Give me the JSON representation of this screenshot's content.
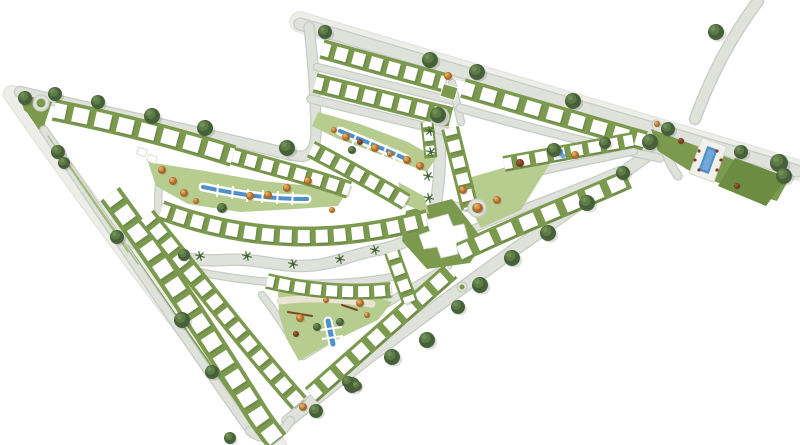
{
  "page": {
    "type": "residential-master-plan-illustration",
    "background": "#ffffff"
  },
  "palette": {
    "road": "#dfe1db",
    "road_casing": "#c8ccc4",
    "pale": "#edeee9",
    "pale_casing": "#e2e4de",
    "green": "#7c9a4e",
    "park": "#b7cd90",
    "lawn": "#6b8c41",
    "water": "#4f90c8",
    "water_light": "#72a9d6",
    "house": "#fefefe",
    "house_edge": "#d8dbd2",
    "shadow": "rgba(70,80,60,0.22)",
    "tree_dark": "#46613a",
    "tree_dark_mid": "#5d7b47",
    "tree_dark_hi": "#6f8f55",
    "tree_orange": "#a86a2c",
    "tree_orange_mid": "#cf9045",
    "tree_orange_hi": "#e4b062",
    "tree_brown": "#6e3a20",
    "tree_brown_mid": "#8a5030",
    "tree_brown_hi": "#a06038",
    "palm": "#4e7340",
    "lot_line": "#a3b97a",
    "plaza": "#e9e5d2",
    "equipment": "#7a4a28",
    "lounger": "#8a3b2a"
  },
  "map": {
    "roads": [
      {
        "n": "outer-street-left",
        "d": "M 12,94 C 100,220 190,340 278,446",
        "w": 16,
        "c": "#edeee9",
        "cc": "#e2e4de"
      },
      {
        "n": "left-green-strip",
        "d": "M 26,104 C 100,212 180,328 256,434",
        "w": 8,
        "c": "#7c9a4e",
        "cc": "none"
      },
      {
        "n": "top-boulevard-verge",
        "d": "M 300,22 L 798,170",
        "w": 19,
        "c": "#edeee9",
        "cc": "#e2e4de"
      },
      {
        "n": "top-boulevard",
        "d": "M 300,24 L 797,171",
        "w": 11
      },
      {
        "n": "top-right-stub",
        "d": "M 758,1 C 731,37 711,75 695,119",
        "w": 10
      },
      {
        "n": "northwest-boundary",
        "d": "M 20,92 C 108,113 203,133 292,155",
        "w": 10
      },
      {
        "n": "northwest-branch",
        "d": "M 292,155 C 312,161 317,146 316,124 C 315,95 313,58 309,27",
        "w": 9
      },
      {
        "n": "left-lane",
        "d": "M 44,130 C 95,205 170,318 248,428",
        "w": 7
      },
      {
        "n": "southeast-boundary",
        "d": "M 288,421 C 390,338 510,252 658,148",
        "w": 11
      },
      {
        "n": "tip-connector",
        "d": "M 250,431 C 264,442 280,437 290,421",
        "w": 8
      },
      {
        "n": "central-boulevard",
        "d": "M 130,240 C 160,256 190,262 225,260 C 258,258 272,266 302,266 C 332,266 352,254 377,250 C 410,245 431,228 436,201 C 441,173 440,146 440,119",
        "w": 10
      },
      {
        "n": "lane-t1-t2",
        "d": "M 317,67 L 453,101",
        "w": 6
      },
      {
        "n": "lane-t2-park",
        "d": "M 311,99 L 452,133",
        "w": 7
      },
      {
        "n": "lane-vertical",
        "d": "M 452,83 L 461,122",
        "w": 6
      },
      {
        "n": "lane-t3-south",
        "d": "M 460,108 C 530,128 600,146 660,158",
        "w": 7
      },
      {
        "n": "lane-rc2-rc1",
        "d": "M 497,182 C 550,168 595,160 634,151",
        "w": 6
      },
      {
        "n": "lane-rc1-top",
        "d": "M 452,238 C 515,210 570,192 620,170",
        "w": 6
      },
      {
        "n": "culdesac-stub",
        "d": "M 452,205 L 468,208",
        "w": 6
      },
      {
        "n": "lane-south-boulevard",
        "d": "M 172,266 C 240,283 320,290 392,277",
        "w": 6
      },
      {
        "n": "lane-playground-west",
        "d": "M 262,295 C 277,314 289,334 301,353",
        "w": 6
      },
      {
        "n": "lane-br1-top",
        "d": "M 303,356 C 350,327 398,296 448,266",
        "w": 6
      },
      {
        "n": "lane-v-middle",
        "d": "M 155,224 C 205,287 252,343 303,398",
        "w": 6
      },
      {
        "n": "lane-bv1-bv2",
        "d": "M 126,205 C 172,268 218,337 262,420",
        "w": 6
      },
      {
        "n": "lane-intersection-up",
        "d": "M 168,260 C 159,230 156,202 160,176",
        "w": 6
      },
      {
        "n": "parcel-access",
        "d": "M 656,124 C 662,144 668,162 678,176",
        "w": 7
      }
    ],
    "areas": [
      {
        "n": "park-lens-main",
        "pts": "148,162 205,171 262,181 312,186 346,193 338,206 296,209 240,212 188,204 156,186",
        "f": "#b7cd90"
      },
      {
        "n": "park-lens-upper",
        "pts": "318,112 360,124 408,142 436,158 427,172 384,156 336,138 312,126",
        "f": "#b7cd90"
      },
      {
        "n": "park-playground",
        "pts": "278,292 314,286 374,296 392,302 378,320 340,338 314,352 299,361 286,338 279,314",
        "f": "#b7cd90"
      },
      {
        "n": "clubhouse-green",
        "pts": "406,211 452,199 484,241 470,263 427,269 402,241",
        "f": "#7c9a4e"
      },
      {
        "n": "park-wedge",
        "pts": "468,178 541,157 559,149 521,210 481,228 469,206",
        "f": "#b7cd90"
      },
      {
        "n": "amenity-parcel-band",
        "pts": "651,129 705,149 761,170 789,179 777,201 733,189 688,170 658,151",
        "f": "#7c9a4e"
      },
      {
        "n": "amenity-parcel-lawn",
        "pts": "735,158 787,177 766,206 718,186",
        "f": "#6b8c41"
      },
      {
        "n": "corner-wedge-green",
        "pts": "20,94 52,102 44,126 24,110",
        "f": "#7c9a4e"
      },
      {
        "n": "triangle-green-m3",
        "pts": "398,182 424,196 429,214 404,204",
        "f": "#b7cd90"
      }
    ],
    "lines": [
      {
        "n": "lot-line",
        "d": "M 48,136 L 120,240",
        "w": 1.2,
        "c": "#a3b97a"
      },
      {
        "n": "lot-line",
        "d": "M 58,150 L 128,252",
        "w": 1.2,
        "c": "#a3b97a"
      },
      {
        "n": "lot-line",
        "d": "M 70,166 L 138,264",
        "w": 1.2,
        "c": "#a3b97a"
      },
      {
        "n": "plaza-path",
        "d": "M 280,301 C 310,297 342,299 372,304",
        "w": 7,
        "c": "#e9e5d2"
      },
      {
        "n": "playground-equipment",
        "d": "M 288,312 L 312,316",
        "w": 2,
        "c": "#7a4a28"
      },
      {
        "n": "playground-equipment",
        "d": "M 342,305 L 357,310",
        "w": 2,
        "c": "#7a4a28"
      }
    ],
    "strips": [
      {
        "n": "housing-row-t1",
        "d": "M 322,49 L 445,83",
        "w": 20,
        "hw": 13,
        "dash": "12 6"
      },
      {
        "n": "housing-row-t2",
        "d": "M 315,83 L 451,117",
        "w": 20,
        "hw": 13,
        "dash": "12 6"
      },
      {
        "n": "housing-row-t3",
        "d": "M 463,88 L 645,141",
        "w": 20,
        "hw": 13,
        "dash": "15 8"
      },
      {
        "n": "housing-row-rc2",
        "d": "M 504,164 L 633,140",
        "w": 16,
        "hw": 11,
        "dash": "12 6"
      },
      {
        "n": "housing-row-rc1",
        "d": "M 459,253 C 515,226 570,205 628,179",
        "w": 20,
        "hw": 14,
        "dash": "16 8"
      },
      {
        "n": "housing-row-rc3",
        "d": "M 450,128 L 470,208",
        "w": 18,
        "hw": 12,
        "dash": "11 6"
      },
      {
        "n": "housing-row-m1a",
        "d": "M 54,110 C 118,123 180,139 233,156",
        "w": 22,
        "hw": 15,
        "dash": "16 7"
      },
      {
        "n": "housing-row-m1b",
        "d": "M 233,156 C 272,167 312,177 349,190",
        "w": 18,
        "hw": 12,
        "dash": "11 6"
      },
      {
        "n": "housing-row-m3",
        "d": "M 311,149 C 345,167 376,184 406,202",
        "w": 18,
        "hw": 12,
        "dash": "11 6"
      },
      {
        "n": "housing-row-m4",
        "d": "M 161,210 C 245,241 330,246 428,219",
        "w": 20,
        "hw": 13,
        "dash": "12 6"
      },
      {
        "n": "housing-row-bs1",
        "d": "M 267,281 C 310,291 350,294 391,290",
        "w": 16,
        "hw": 11,
        "dash": "11 5"
      },
      {
        "n": "housing-row-bv1",
        "d": "M 110,194 C 160,262 205,330 256,412 C 262,422 270,432 277,441",
        "w": 24,
        "hw": 16,
        "dash": "15 7"
      },
      {
        "n": "housing-row-bv2",
        "d": "M 146,216 C 195,276 245,342 299,403",
        "w": 20,
        "hw": 13,
        "dash": "12 6"
      },
      {
        "n": "housing-row-br1",
        "d": "M 311,395 C 360,352 405,312 451,271",
        "w": 19,
        "hw": 13,
        "dash": "14 7"
      },
      {
        "n": "housing-row-br2",
        "d": "M 392,252 C 398,270 404,285 410,302",
        "w": 16,
        "hw": 11,
        "dash": "11 6"
      },
      {
        "n": "housing-row-mini",
        "d": "M 427,122 L 431,158",
        "w": 13,
        "hw": 9,
        "dash": "9 5"
      }
    ],
    "water": [
      {
        "n": "canal-upper-park",
        "d": "M 340,131 C 362,140 386,150 406,159",
        "w": 4,
        "uw": 9,
        "cross": [
          "352,145 357,133",
          "367,151 372,139",
          "382,157 387,145",
          "393,162 398,150"
        ]
      },
      {
        "n": "canal-main-park",
        "d": "M 203,187 C 245,196 275,199 307,199",
        "w": 4,
        "uw": 9,
        "cross": [
          "218,184 217,197",
          "233,186 232,199",
          "248,189 247,202",
          "263,190 262,203",
          "278,191 277,204",
          "293,192 292,205"
        ]
      },
      {
        "n": "water-playground",
        "d": "M 328,321 L 333,344",
        "w": 5,
        "uw": 9,
        "cross": [
          "320,330 342,327",
          "322,339 343,336"
        ]
      }
    ],
    "rects": [
      {
        "n": "pool-deck",
        "x": 708,
        "y": 160,
        "w": 26,
        "h": 38,
        "r": 20,
        "f": "#f0f1ea",
        "s": "#d5d8cf"
      },
      {
        "n": "swimming-pool",
        "x": 708,
        "y": 160,
        "w": 11,
        "h": 26,
        "r": 20,
        "f": "#4f90c8"
      },
      {
        "n": "swimming-pool-inner",
        "x": 708,
        "y": 160,
        "w": 7,
        "h": 21,
        "r": 20,
        "f": "#72a9d6"
      },
      {
        "n": "green-square-parcel",
        "x": 449,
        "y": 92,
        "w": 15,
        "h": 13,
        "r": 17,
        "f": "#7c9a4e",
        "s": "#ffffff"
      },
      {
        "n": "small-building",
        "x": 142,
        "y": 152,
        "w": 9,
        "h": 7,
        "r": 20,
        "f": "#ffffff",
        "s": "#d8dbd2"
      },
      {
        "n": "small-building",
        "x": 152,
        "y": 159,
        "w": 9,
        "h": 7,
        "r": 20,
        "f": "#ffffff",
        "s": "#d8dbd2"
      }
    ],
    "buildings": [
      {
        "n": "clubhouse-building",
        "pts": "426,220 448,214 453,226 464,224 468,238 456,243 458,254 441,258 437,247 424,249 419,235 430,231",
        "f": "#ffffff",
        "s": "#cfd4cb"
      }
    ],
    "dots": [
      {
        "n": "pond",
        "x": 559,
        "y": 152,
        "r": 4,
        "c": "#4f90c8"
      },
      {
        "n": "pond-highlight",
        "x": 563,
        "y": 156,
        "r": 2.5,
        "c": "#72a9d6"
      },
      {
        "n": "sun-lounger",
        "x": 699,
        "y": 151,
        "r": 1.6,
        "c": "#8a3b2a"
      },
      {
        "n": "sun-lounger",
        "x": 695,
        "y": 160,
        "r": 1.6,
        "c": "#8a3b2a"
      },
      {
        "n": "sun-lounger",
        "x": 699,
        "y": 170,
        "r": 1.6,
        "c": "#8a3b2a"
      },
      {
        "n": "sun-lounger",
        "x": 717,
        "y": 151,
        "r": 1.6,
        "c": "#8a3b2a"
      },
      {
        "n": "sun-lounger",
        "x": 721,
        "y": 160,
        "r": 1.6,
        "c": "#8a3b2a"
      },
      {
        "n": "sun-lounger",
        "x": 717,
        "y": 170,
        "r": 1.6,
        "c": "#8a3b2a"
      }
    ],
    "trees": [
      [
        25,
        98,
        7,
        "d"
      ],
      [
        55,
        94,
        7,
        "d"
      ],
      [
        98,
        102,
        7,
        "d"
      ],
      [
        152,
        116,
        8,
        "d"
      ],
      [
        205,
        128,
        8,
        "d"
      ],
      [
        287,
        148,
        8,
        "d"
      ],
      [
        58,
        152,
        7,
        "d"
      ],
      [
        64,
        163,
        6,
        "d"
      ],
      [
        117,
        237,
        7,
        "d"
      ],
      [
        182,
        320,
        8,
        "d"
      ],
      [
        212,
        372,
        7,
        "d"
      ],
      [
        230,
        438,
        6,
        "d"
      ],
      [
        325,
        32,
        7,
        "d"
      ],
      [
        430,
        60,
        8,
        "d"
      ],
      [
        477,
        72,
        8,
        "d"
      ],
      [
        573,
        101,
        8,
        "d"
      ],
      [
        650,
        142,
        8,
        "d"
      ],
      [
        668,
        129,
        7,
        "d"
      ],
      [
        716,
        32,
        8,
        "d"
      ],
      [
        741,
        152,
        7,
        "d"
      ],
      [
        779,
        163,
        9,
        "d"
      ],
      [
        784,
        176,
        8,
        "d"
      ],
      [
        623,
        173,
        7,
        "d"
      ],
      [
        587,
        203,
        8,
        "d"
      ],
      [
        548,
        233,
        8,
        "d"
      ],
      [
        512,
        258,
        8,
        "d"
      ],
      [
        480,
        285,
        8,
        "d"
      ],
      [
        458,
        307,
        7,
        "d"
      ],
      [
        427,
        340,
        8,
        "d"
      ],
      [
        392,
        357,
        8,
        "d"
      ],
      [
        352,
        385,
        8,
        "d"
      ],
      [
        316,
        411,
        7,
        "d"
      ],
      [
        438,
        115,
        8,
        "d"
      ],
      [
        554,
        150,
        7,
        "d"
      ],
      [
        184,
        255,
        6,
        "d"
      ],
      [
        222,
        208,
        5,
        "d"
      ],
      [
        352,
        150,
        4,
        "d"
      ],
      [
        317,
        327,
        4,
        "d"
      ],
      [
        340,
        322,
        4,
        "d"
      ],
      [
        348,
        382,
        6,
        "d"
      ],
      [
        357,
        386,
        5,
        "d"
      ],
      [
        605,
        143,
        6,
        "d"
      ],
      [
        162,
        170,
        4,
        "o"
      ],
      [
        173,
        181,
        4,
        "o"
      ],
      [
        184,
        193,
        4,
        "o"
      ],
      [
        196,
        201,
        3,
        "o"
      ],
      [
        250,
        196,
        4,
        "o"
      ],
      [
        268,
        195,
        4,
        "o"
      ],
      [
        287,
        188,
        4,
        "o"
      ],
      [
        308,
        181,
        4,
        "o"
      ],
      [
        332,
        210,
        3,
        "o"
      ],
      [
        334,
        130,
        3,
        "o"
      ],
      [
        346,
        137,
        4,
        "o"
      ],
      [
        375,
        148,
        4,
        "o"
      ],
      [
        390,
        154,
        3,
        "o"
      ],
      [
        407,
        160,
        4,
        "o"
      ],
      [
        420,
        166,
        4,
        "o"
      ],
      [
        478,
        208,
        5,
        "o"
      ],
      [
        497,
        200,
        4,
        "o"
      ],
      [
        463,
        190,
        4,
        "o"
      ],
      [
        300,
        318,
        4,
        "o"
      ],
      [
        360,
        303,
        4,
        "o"
      ],
      [
        367,
        315,
        3,
        "o"
      ],
      [
        326,
        300,
        3,
        "o"
      ],
      [
        575,
        155,
        4,
        "o"
      ],
      [
        657,
        124,
        3,
        "o"
      ],
      [
        448,
        76,
        4,
        "o"
      ],
      [
        303,
        407,
        4,
        "o"
      ],
      [
        360,
        142,
        3,
        "b"
      ],
      [
        296,
        334,
        3,
        "b"
      ],
      [
        681,
        141,
        3,
        "b"
      ],
      [
        737,
        186,
        3,
        "b"
      ],
      [
        520,
        163,
        4,
        "b"
      ],
      [
        200,
        256,
        5,
        "p"
      ],
      [
        247,
        256,
        5,
        "p"
      ],
      [
        293,
        264,
        5,
        "p"
      ],
      [
        340,
        259,
        5,
        "p"
      ],
      [
        375,
        250,
        5,
        "p"
      ],
      [
        430,
        131,
        5,
        "p"
      ],
      [
        431,
        152,
        5,
        "p"
      ],
      [
        428,
        176,
        5,
        "p"
      ],
      [
        429,
        198,
        5,
        "p"
      ]
    ],
    "roundabouts": [
      {
        "n": "roundabout-northwest",
        "x": 41,
        "y": 103,
        "r": 8,
        "ir": 4.5
      },
      {
        "n": "roundabout-central",
        "x": 440,
        "y": 117,
        "r": 9,
        "ir": 5
      },
      {
        "n": "culdesac-circle",
        "x": 477,
        "y": 208,
        "r": 9,
        "ir": 5
      },
      {
        "n": "mini-circle-south",
        "x": 462,
        "y": 287,
        "r": 5,
        "ir": 2.5
      }
    ]
  }
}
